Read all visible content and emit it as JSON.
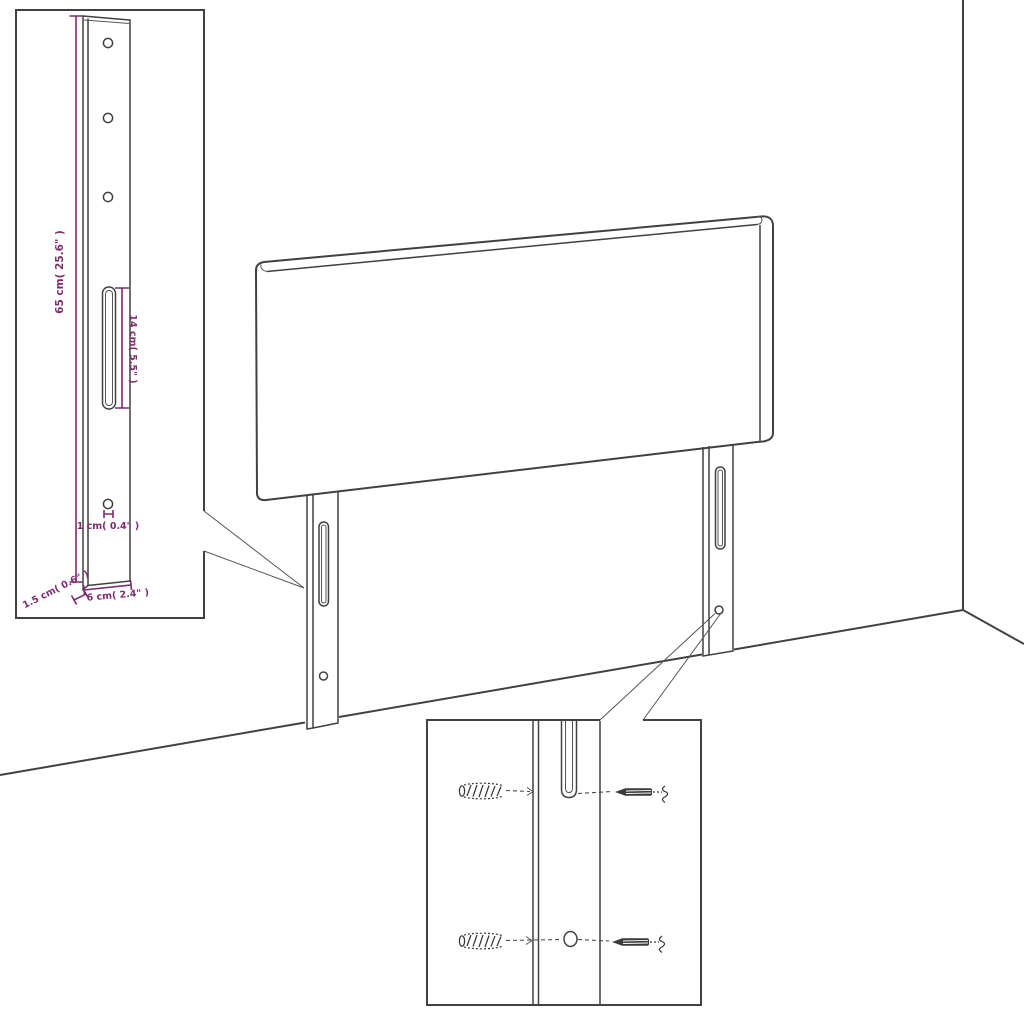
{
  "colors": {
    "line_color": "#414141",
    "dimension_color": "#7e2b6f",
    "background": "#ffffff"
  },
  "dimension_inset": {
    "labels": {
      "leg_height": "65 cm( 25.6\" )",
      "slot_length": "14 cm( 5.5\" )",
      "hole_diameter": "1 cm( 0.4\" )",
      "leg_thickness": "1.5 cm( 0.6\" )",
      "leg_width": "6 cm( 2.4\" )"
    },
    "features": {
      "top_holes": 3,
      "slots": 1,
      "bottom_holes": 1
    }
  },
  "hardware_inset": {
    "wall_plugs": 2,
    "screws": 2
  }
}
